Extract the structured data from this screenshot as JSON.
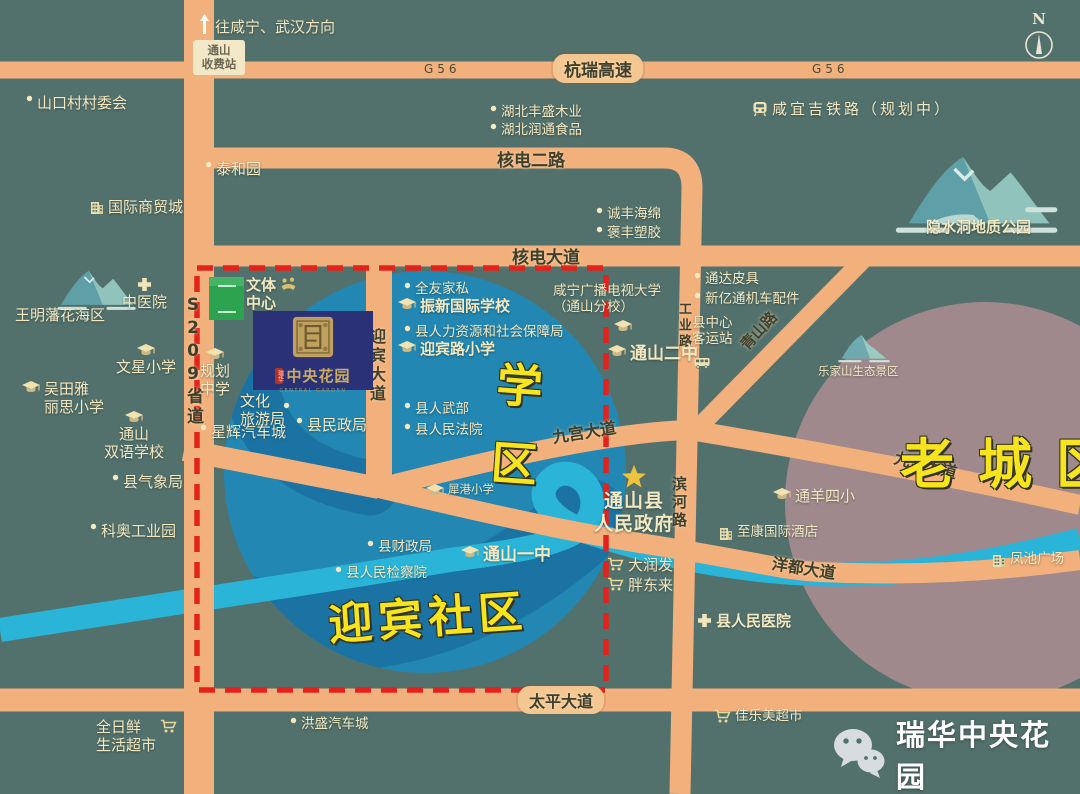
{
  "colors": {
    "background": "#53716c",
    "road": "#f1b07c",
    "river": "#2ab5d8",
    "school_circle": "#2287b2",
    "water_shade": "#1b73a3",
    "old_town_circle": "#9f898c",
    "poi_text": "#f2e8c2",
    "road_text": "#3f3f2c",
    "zone_text": "#f6e41f",
    "boundary_red": "#e2231d",
    "project_navy": "#2b3176",
    "field_green": "#2da24f",
    "star_gold": "#eec43f"
  },
  "compass": {
    "label": "N"
  },
  "direction_note": {
    "text": "往咸宁、武汉方向"
  },
  "toll": {
    "line1": "通山",
    "line2": "收费站"
  },
  "project": {
    "title": "中央花园",
    "seal": "瑞华",
    "subtitle": "CENTRAL GARDEN"
  },
  "brand": {
    "text": "瑞华中央花园"
  },
  "zones": [
    {
      "name": "zone-school-district",
      "chars": [
        "学",
        "区"
      ],
      "stacked": true,
      "x": 494,
      "y": 350,
      "size": 46,
      "rot": 4,
      "ls": 0
    },
    {
      "name": "zone-yingbin-community",
      "chars": [
        "迎宾社区"
      ],
      "stacked": false,
      "x": 328,
      "y": 582,
      "size": 44,
      "rot": -4,
      "ls": 6
    },
    {
      "name": "zone-old-town",
      "chars": [
        "老城区"
      ],
      "stacked": false,
      "x": 900,
      "y": 420,
      "size": 54,
      "rot": 0,
      "ls": 24
    }
  ],
  "road_labels": [
    {
      "text": "G56",
      "x": 424,
      "y": 62,
      "cls": "g56"
    },
    {
      "text": "G56",
      "x": 812,
      "y": 62,
      "cls": "g56"
    },
    {
      "text": "杭瑞高速",
      "x": 553,
      "y": 54,
      "cls": "pill",
      "size": 17
    },
    {
      "text": "核电二路",
      "x": 497,
      "y": 146,
      "size": 17
    },
    {
      "text": "核电大道",
      "x": 512,
      "y": 243,
      "size": 17
    },
    {
      "text": "九宫大道",
      "x": 552,
      "y": 419,
      "rot": -9,
      "size": 16
    },
    {
      "text": "九宫大道",
      "x": 894,
      "y": 452,
      "rot": 14,
      "size": 16
    },
    {
      "text": "青山路",
      "x": 736,
      "y": 320,
      "rot": -47,
      "size": 15
    },
    {
      "text": "洋都大道",
      "x": 772,
      "y": 555,
      "rot": 9,
      "size": 16
    },
    {
      "text": "太平大道",
      "x": 518,
      "y": 686,
      "cls": "pill",
      "size": 16
    },
    {
      "text": "S209省道",
      "x": 181,
      "y": 295,
      "cls": "vert",
      "size": 17
    },
    {
      "text": "迎宾大道",
      "x": 364,
      "y": 328,
      "cls": "vert",
      "size": 16
    },
    {
      "text": "工业路",
      "x": 674,
      "y": 302,
      "cls": "vert",
      "size": 13
    },
    {
      "text": "滨河路",
      "x": 669,
      "y": 476,
      "cls": "vert",
      "size": 15
    }
  ],
  "pois": [
    {
      "icon": "dot",
      "x": 26,
      "y": 94,
      "lines": [
        "山口村村委会"
      ],
      "cls": "big"
    },
    {
      "icon": "dot",
      "x": 205,
      "y": 160,
      "lines": [
        "泰和园"
      ],
      "cls": "big"
    },
    {
      "icon": "bldg",
      "x": 90,
      "y": 198,
      "lines": [
        "国际商贸城"
      ],
      "cls": "big"
    },
    {
      "icon": "dot",
      "x": 490,
      "y": 104,
      "lines": [
        "湖北丰盛木业"
      ]
    },
    {
      "icon": "dot",
      "x": 490,
      "y": 122,
      "lines": [
        "湖北润通食品"
      ]
    },
    {
      "icon": "dot",
      "x": 596,
      "y": 206,
      "lines": [
        "诚丰海绵"
      ]
    },
    {
      "icon": "dot",
      "x": 596,
      "y": 225,
      "lines": [
        "褒丰塑胶"
      ]
    },
    {
      "icon": "train",
      "x": 752,
      "y": 100,
      "lines": [
        "咸宜吉铁路（规划中）"
      ],
      "cls": "spaced"
    },
    {
      "icon": "mtn-lg",
      "x": 895,
      "y": 140,
      "lines": []
    },
    {
      "icon": "none",
      "x": 926,
      "y": 218,
      "lines": [
        "隐水洞地质公园"
      ],
      "cls": "big bold"
    },
    {
      "icon": "mtn-md",
      "x": 50,
      "y": 262,
      "lines": []
    },
    {
      "icon": "none",
      "x": 15,
      "y": 306,
      "lines": [
        "王明藩花海区"
      ],
      "cls": "big"
    },
    {
      "icon": "cross",
      "x": 122,
      "y": 276,
      "lines": [
        "中医院"
      ],
      "iconPos": "above",
      "cls": "big"
    },
    {
      "icon": "cap",
      "x": 116,
      "y": 343,
      "lines": [
        "文星小学"
      ],
      "iconPos": "above",
      "cls": "big"
    },
    {
      "icon": "cap",
      "x": 22,
      "y": 380,
      "lines": [
        "吴田雅",
        "丽思小学"
      ],
      "cls": "big"
    },
    {
      "icon": "cap",
      "x": 104,
      "y": 410,
      "lines": [
        "通山",
        "双语学校"
      ],
      "iconPos": "above",
      "cls": "big"
    },
    {
      "icon": "dot",
      "x": 112,
      "y": 473,
      "lines": [
        "县气象局"
      ],
      "cls": "big"
    },
    {
      "icon": "dot",
      "x": 90,
      "y": 522,
      "lines": [
        "科奥工业园"
      ],
      "cls": "big"
    },
    {
      "icon": "fit",
      "x": 246,
      "y": 276,
      "lines": [
        "文体",
        "中心"
      ],
      "iconPos": "right",
      "cls": "big bold"
    },
    {
      "icon": "cap",
      "x": 200,
      "y": 347,
      "lines": [
        "规划",
        "中学"
      ],
      "iconPos": "above",
      "cls": "big"
    },
    {
      "icon": "none",
      "x": 240,
      "y": 392,
      "lines": [
        "文化",
        "旅游局"
      ],
      "cls": "big"
    },
    {
      "icon": "dot",
      "x": 283,
      "y": 401,
      "lines": []
    },
    {
      "icon": "dot",
      "x": 200,
      "y": 423,
      "lines": [
        "星辉汽车城"
      ],
      "cls": "big"
    },
    {
      "icon": "dot",
      "x": 296,
      "y": 416,
      "lines": [
        "县民政局"
      ],
      "cls": "big"
    },
    {
      "icon": "dot",
      "x": 404,
      "y": 281,
      "lines": [
        "全友家私"
      ]
    },
    {
      "icon": "cap",
      "x": 398,
      "y": 297,
      "lines": [
        "振新国际学校"
      ],
      "cls": "big bold"
    },
    {
      "icon": "dot",
      "x": 404,
      "y": 324,
      "lines": [
        "县人力资源和社会保障局"
      ]
    },
    {
      "icon": "cap",
      "x": 398,
      "y": 340,
      "lines": [
        "迎宾路小学"
      ],
      "cls": "big bold"
    },
    {
      "icon": "dot",
      "x": 404,
      "y": 401,
      "lines": [
        "县人武部"
      ]
    },
    {
      "icon": "dot",
      "x": 404,
      "y": 422,
      "lines": [
        "县人民法院"
      ]
    },
    {
      "icon": "none",
      "x": 553,
      "y": 283,
      "lines": [
        "咸宁广播电视大学",
        "（通山分校）"
      ]
    },
    {
      "icon": "cap",
      "x": 614,
      "y": 319,
      "lines": []
    },
    {
      "icon": "cap",
      "x": 608,
      "y": 344,
      "lines": [
        "通山二中"
      ],
      "cls": "big2"
    },
    {
      "icon": "cap",
      "x": 426,
      "y": 483,
      "lines": [
        "犀港小学"
      ],
      "cls": "small"
    },
    {
      "icon": "dot",
      "x": 367,
      "y": 539,
      "lines": [
        "县财政局"
      ]
    },
    {
      "icon": "dot",
      "x": 335,
      "y": 565,
      "lines": [
        "县人民检察院"
      ]
    },
    {
      "icon": "cap",
      "x": 461,
      "y": 545,
      "lines": [
        "通山一中"
      ],
      "cls": "big2"
    },
    {
      "icon": "star",
      "x": 594,
      "y": 464,
      "lines": [
        "通山县",
        "人民政府"
      ],
      "iconPos": "above",
      "cls": "gov"
    },
    {
      "icon": "cart",
      "x": 607,
      "y": 556,
      "lines": [
        "大润发"
      ],
      "cls": "big"
    },
    {
      "icon": "cart",
      "x": 607,
      "y": 576,
      "lines": [
        "胖东来"
      ],
      "cls": "big"
    },
    {
      "icon": "dot",
      "x": 694,
      "y": 271,
      "lines": [
        "通达皮具"
      ]
    },
    {
      "icon": "dot",
      "x": 694,
      "y": 291,
      "lines": [
        "新亿通机车配件"
      ]
    },
    {
      "icon": "none",
      "x": 692,
      "y": 315,
      "lines": [
        "县中心",
        "客运站"
      ]
    },
    {
      "icon": "bus",
      "x": 694,
      "y": 356,
      "lines": []
    },
    {
      "icon": "mtn-sm",
      "x": 833,
      "y": 328,
      "lines": []
    },
    {
      "icon": "none",
      "x": 818,
      "y": 365,
      "lines": [
        "乐家山生态景区"
      ],
      "cls": "small"
    },
    {
      "icon": "cap",
      "x": 773,
      "y": 487,
      "lines": [
        "通羊四小"
      ],
      "cls": "big"
    },
    {
      "icon": "bldg",
      "x": 719,
      "y": 524,
      "lines": [
        "至康国际酒店"
      ]
    },
    {
      "icon": "bldg",
      "x": 992,
      "y": 551,
      "lines": [
        "凤池广场"
      ]
    },
    {
      "icon": "cross",
      "x": 697,
      "y": 612,
      "lines": [
        "县人民医院"
      ],
      "cls": "big bold"
    },
    {
      "icon": "dot",
      "x": 290,
      "y": 716,
      "lines": [
        "洪盛汽车城"
      ]
    },
    {
      "icon": "cart",
      "x": 714,
      "y": 708,
      "lines": [
        "佳乐美超市"
      ]
    },
    {
      "icon": "cart",
      "x": 96,
      "y": 718,
      "lines": [
        "全日鲜",
        "生活超市"
      ],
      "iconPos": "right",
      "cls": "big"
    }
  ]
}
